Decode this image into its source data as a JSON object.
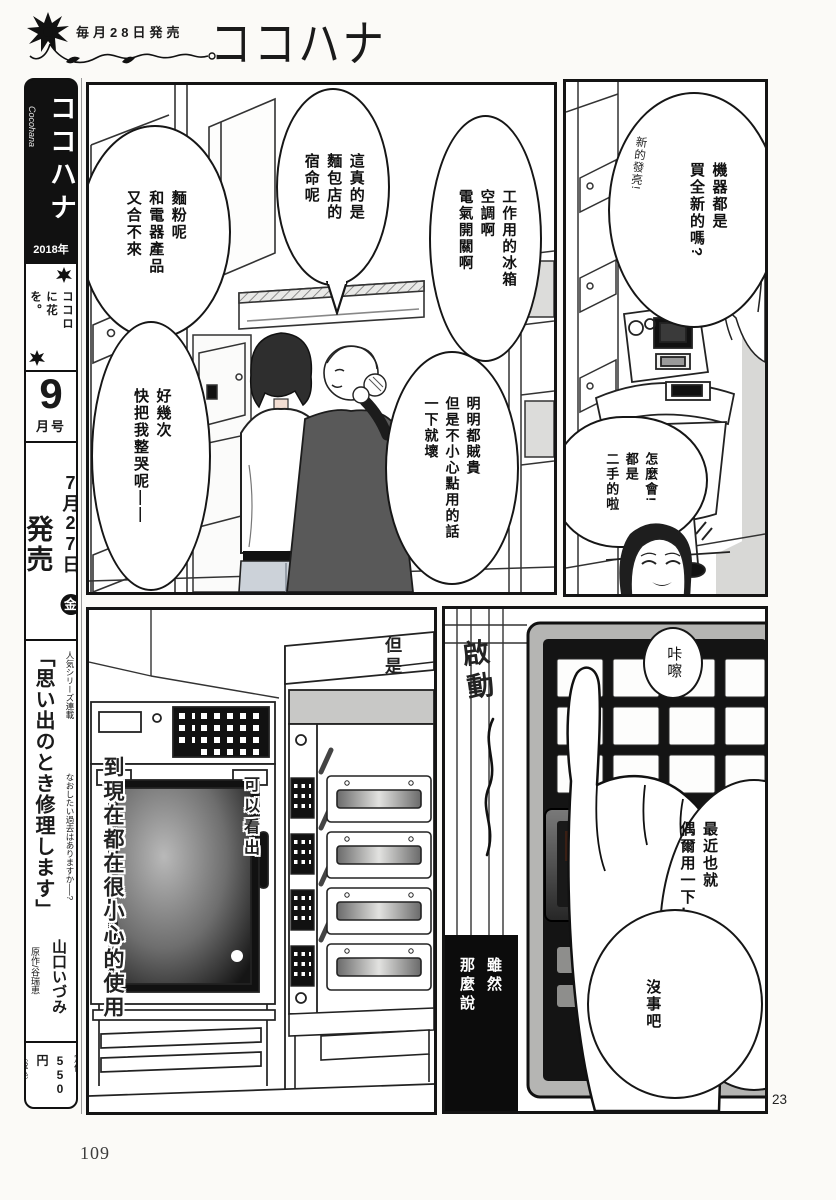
{
  "header": {
    "release": "毎月28日発売",
    "logo": "ココハナ"
  },
  "sidebar": {
    "logo": "ココハナ",
    "roman": "Cocohana",
    "year": "2018年",
    "slogan": "ココロに花を。",
    "issue_no": "9",
    "issue_unit": "月号",
    "date": "7月27日",
    "week": "金",
    "sale": "発売",
    "series_note": "人気シリーズ連載",
    "series_title": "「思い出のとき修理します」",
    "tagline": "なおしたい過去はありますか──?",
    "author": "山口いづみ",
    "original": "原作/谷瑞恵",
    "price_label": "定価",
    "price": "550円",
    "tax": "〔税込〕"
  },
  "p1": {
    "b_flour": "麵粉呢\n和電器產品\n又合不來",
    "b_cry": "好幾次\n快把我整哭呢——",
    "b_fate": "這真的是\n麵包店的\n宿命呢",
    "b_appliances": "工作用的冰箱\n空調啊\n電氣開關啊",
    "b_expensive": "明明都賊貴\n但是不小心點用的話\n一下就壞"
  },
  "p2": {
    "b_new": "機器都是\n買全新的嗎?",
    "note_shiny": "新的發亮!",
    "b_secondhand": "怎麼會!\n都是\n二手的啦"
  },
  "p3": {
    "note_but": "但是",
    "cap_see": "可以看出",
    "cap_careful": "到現在都在很小心的使用"
  },
  "p4": {
    "sfx_start": "啟動",
    "b_click": "咔嚓",
    "b_recent": "最近也就\n偶爾用一下…",
    "b_fine": "沒事吧",
    "caption_black": "雖然\n那麼說"
  },
  "page": {
    "num_left": "109",
    "num_right": "23"
  },
  "colors": {
    "ink": "#1a1a1a",
    "paper": "#fbfaf7",
    "tone_gray": "#d8d8d8"
  }
}
